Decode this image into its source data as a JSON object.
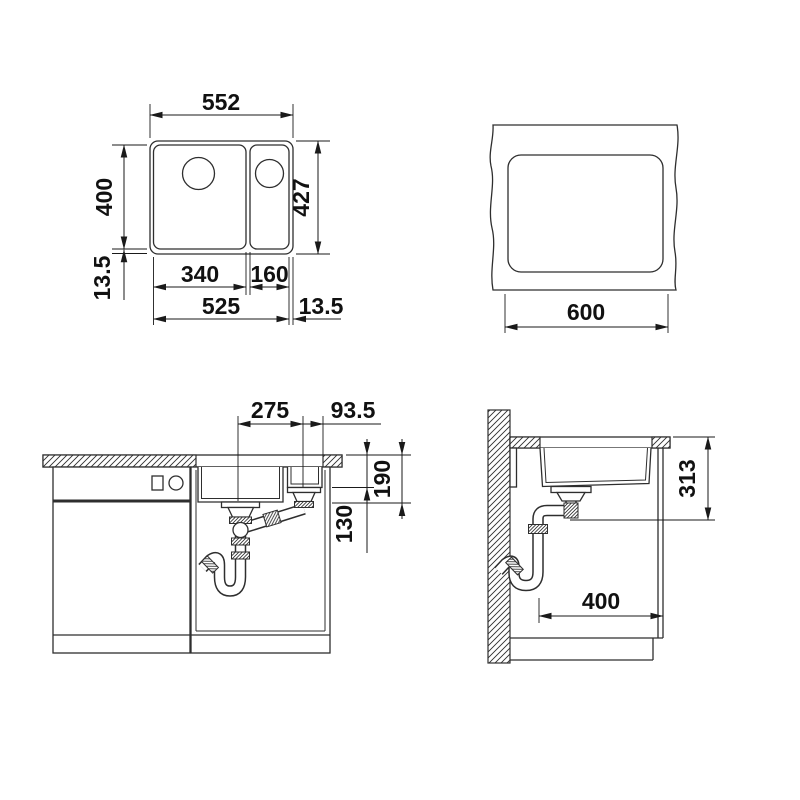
{
  "drawing": {
    "kind": "sink-installation-technical-drawing",
    "colors": {
      "line": "#2e2e2e",
      "dim_text": "#111111",
      "background": "#ffffff"
    },
    "views": {
      "plan": {
        "dims": {
          "overall_width": "552",
          "bowl_length": "400",
          "rim_left": "13.5",
          "overall_length": "427",
          "main_bowl_width": "340",
          "half_bowl_width": "160",
          "bowls_span": "525",
          "rim_right": "13.5"
        }
      },
      "cutout": {
        "dims": {
          "cutout_width": "600"
        }
      },
      "front": {
        "dims": {
          "drain_spacing": "275",
          "drain_to_edge": "93.5",
          "main_bowl_depth": "190",
          "half_bowl_depth": "130"
        }
      },
      "side": {
        "dims": {
          "outlet_height": "313",
          "clearance_depth": "400"
        }
      }
    }
  }
}
